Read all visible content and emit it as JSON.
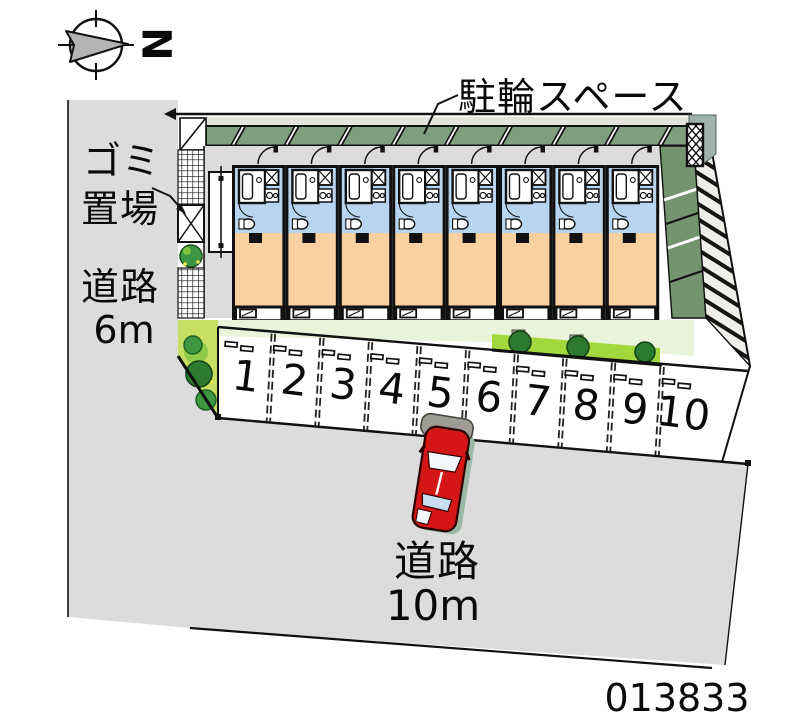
{
  "compass": {
    "north_label": "N"
  },
  "annotations": {
    "bicycle_space_label": "駐輪スペース",
    "garbage_label_line1": "ゴミ",
    "garbage_label_line2": "置場",
    "road_left_line1": "道路",
    "road_left_line2": "6m",
    "road_bottom_line1": "道路",
    "road_bottom_line2": "10m",
    "plan_number": "013833"
  },
  "building": {
    "unit_count": 8
  },
  "parking": {
    "space_numbers": [
      "1",
      "2",
      "3",
      "4",
      "5",
      "6",
      "7",
      "8",
      "9",
      "10"
    ],
    "car_space": "5"
  },
  "colors": {
    "road_gray": "#dcdcdc",
    "roof_green": "#7e9e7e",
    "band_green": "#74936f",
    "unit_blue": "#b7d5f1",
    "unit_orange": "#f9d0a0",
    "lawn_pale": "#e9f4da",
    "hedge_green": "#a3d83c",
    "wedge_green": "#c6df62",
    "tree_dark": "#2c7a2f",
    "tree_mid": "#3f9642",
    "tree_light": "#8fcb4a",
    "car_red": "#d41616",
    "car_shadow": "#9cb8a6",
    "stone_gray": "#9c9c94",
    "box_shadow_gray": "#9fb2ae"
  }
}
